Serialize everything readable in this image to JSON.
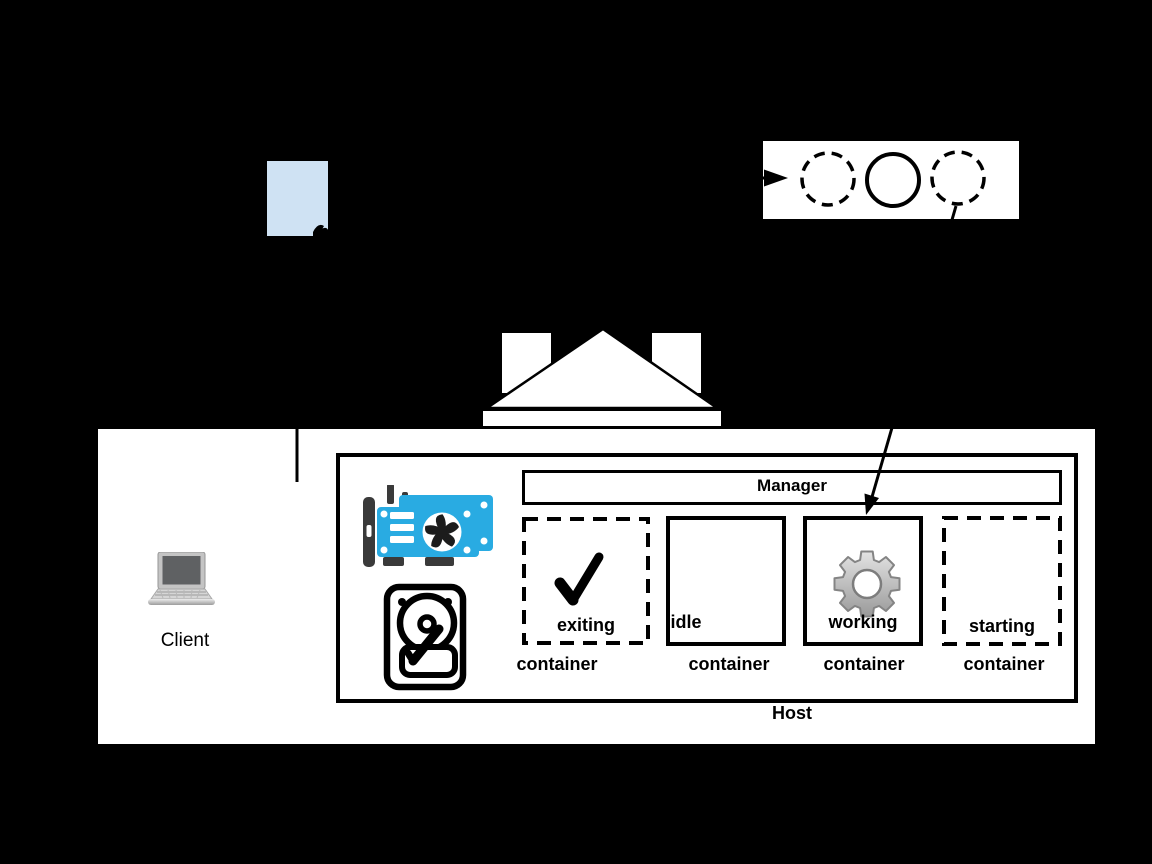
{
  "client": {
    "label": "Client",
    "icon": "laptop-icon"
  },
  "document": {
    "icon": "document-icon",
    "fill_color": "#cfe2f3"
  },
  "worker_pool_strip": {
    "icon_names": [
      "dashed-circle-icon",
      "solid-circle-icon",
      "dashed-circle-icon"
    ],
    "note_arrow_in": "arrowhead-icon"
  },
  "gateway": {
    "icon": "pediment-building-icon"
  },
  "host": {
    "label": "Host",
    "manager_label": "Manager",
    "resources": {
      "gpu_icon": "gpu-card-icon",
      "disk_icon": "hard-drive-icon"
    },
    "containers": [
      {
        "state": "exiting",
        "type_label": "container",
        "border": "dashed",
        "icon": "check-icon"
      },
      {
        "state": "idle",
        "type_label": "container",
        "border": "solid",
        "icon": ""
      },
      {
        "state": "working",
        "type_label": "container",
        "border": "solid",
        "icon": "gear-icon"
      },
      {
        "state": "starting",
        "type_label": "container",
        "border": "dashed",
        "icon": ""
      }
    ]
  },
  "colors": {
    "background": "#000000",
    "panel": "#ffffff",
    "document_fill": "#cfe2f3",
    "gpu_blue": "#29abe2",
    "dark_gray": "#3a3a3a",
    "gear_gray": "#c0c0c0",
    "line": "#000000"
  }
}
